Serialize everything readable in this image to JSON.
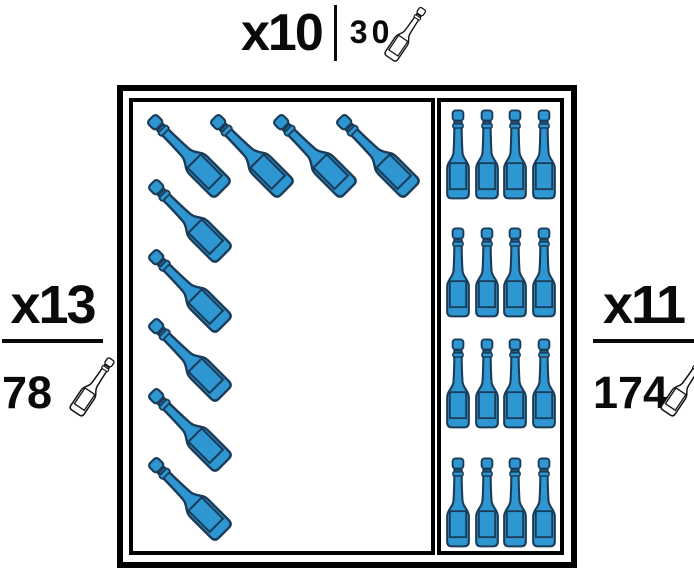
{
  "labels": {
    "top": {
      "multiplier": "x10",
      "count": "30",
      "icon": "wine-bottle-icon"
    },
    "left": {
      "multiplier": "x13",
      "count": "78",
      "icon": "wine-bottle-icon"
    },
    "right": {
      "multiplier": "x11",
      "count": "174",
      "icon": "wine-bottle-icon"
    }
  },
  "box": {
    "groups": [
      {
        "name": "tilted-top-row",
        "orientation": "tilted-45-left",
        "count": 4
      },
      {
        "name": "tilted-left-column",
        "orientation": "tilted-45-left",
        "count": 5
      },
      {
        "name": "upright-grid",
        "orientation": "upright",
        "rows": 4,
        "cols": 4,
        "count": 16
      }
    ],
    "total_bottles_visible": 25
  },
  "colors": {
    "bottle_fill": "#2E96D1",
    "bottle_outline": "#1B3C59",
    "text": "#0A0A0A",
    "border": "#000000",
    "background": "#FFFFFF"
  }
}
